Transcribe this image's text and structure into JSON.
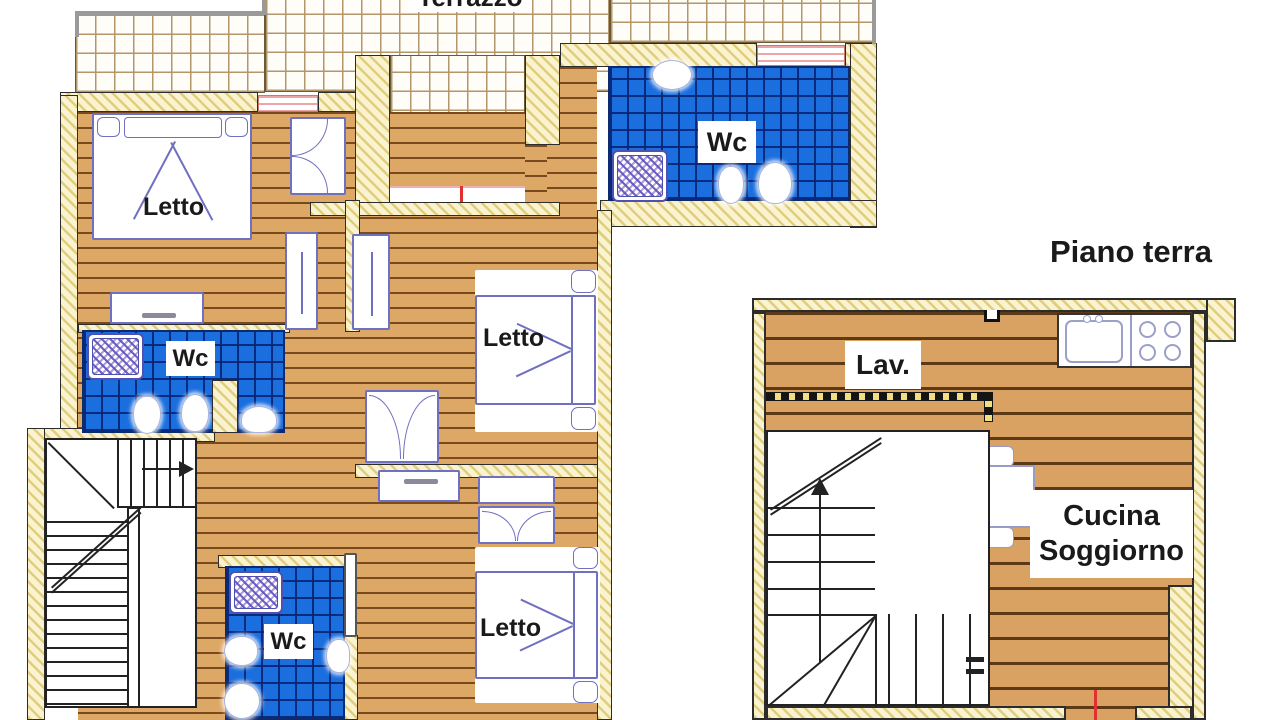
{
  "palette": {
    "wood_fill": "#dda766",
    "wood_line": "#7a4a1f",
    "wall_fill": "#faf3cf",
    "wall_hatch": "#e0cd7e",
    "bath_tile_blue": "#1a6ede",
    "bath_tile_line": "#0d2a6e",
    "terrace_tile_line": "#b5956a",
    "window_pink": "#eda5a5",
    "door_marker_red": "#e03030",
    "furniture_outline": "#7070c0",
    "railing_gray": "#9a9a9a",
    "text_ink": "#1a1a1a"
  },
  "floor_plan_upper": {
    "rooms": {
      "terrace": {
        "label": "Terrazzo"
      },
      "bedroom_1": {
        "label": "Letto"
      },
      "bedroom_2": {
        "label": "Letto"
      },
      "bedroom_3": {
        "label": "Letto"
      },
      "bathroom_1": {
        "label": "Wc"
      },
      "bathroom_2": {
        "label": "Wc"
      },
      "bathroom_3": {
        "label": "Wc"
      }
    }
  },
  "floor_plan_ground": {
    "title": "Piano terra",
    "rooms": {
      "laundry": {
        "label": "Lav."
      },
      "kitchen_living": {
        "label_line1": "Cucina",
        "label_line2": "Soggiorno"
      }
    }
  }
}
